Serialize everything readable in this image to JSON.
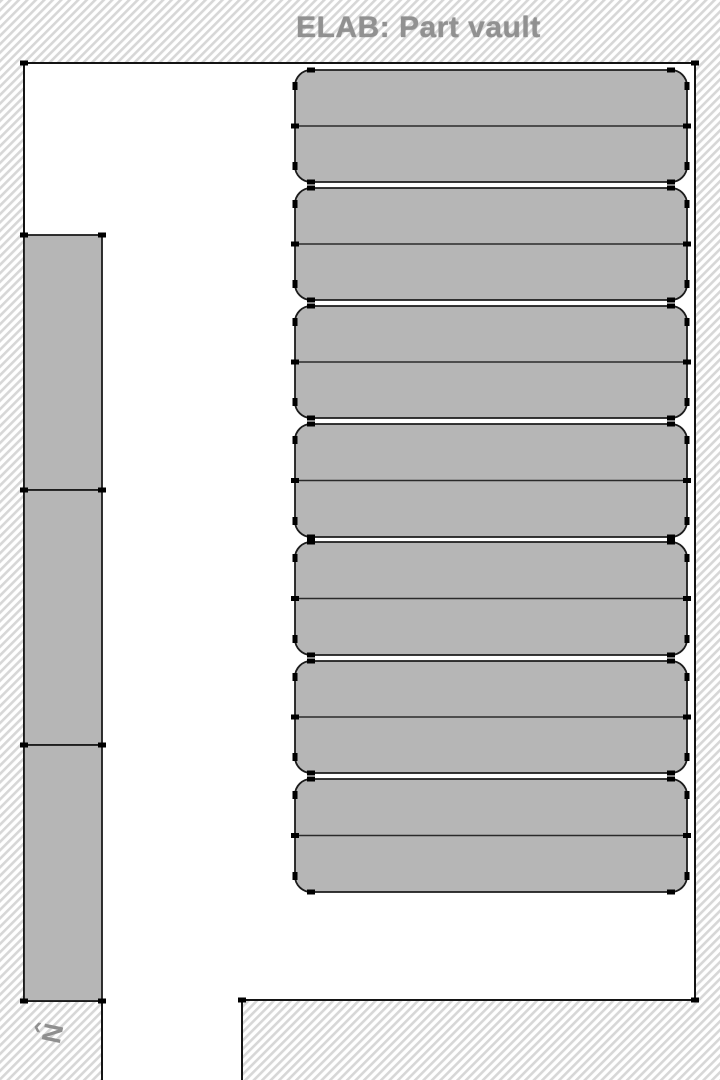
{
  "page": {
    "title": "ELAB: Part vault"
  },
  "compass": {
    "arrow_glyph": "‹",
    "north_label": "N"
  },
  "colors": {
    "exterior_bg": "#ffffff",
    "hatch_stripe": "#d7d7d7",
    "room_fill": "#ffffff",
    "wall_stroke": "#141414",
    "shelf_fill": "#b6b6b6",
    "shelf_stroke": "#1c1c1c",
    "divider_stroke": "#2a2a2a",
    "vertex_fill": "#000000",
    "title_color": "#919191",
    "compass_color": "#8f8f8f"
  },
  "floorplan": {
    "canvas_width": 720,
    "canvas_height": 1080,
    "hatch": {
      "period": 6,
      "stripe_width": 2.6,
      "rotate_deg": -45
    },
    "room_polygon": "24,63 695,63 695,1000 242,1000 242,1080 102,1080 102,1001 24,1001",
    "walls_path": "M24,1001 L24,63 L695,63 L695,1000 L242,1000 L242,1080 M102,1080 L102,1001 L24,1001",
    "room_vertices": [
      [
        24,
        63
      ],
      [
        695,
        63
      ],
      [
        695,
        1000
      ],
      [
        242,
        1000
      ],
      [
        24,
        1001
      ],
      [
        102,
        1001
      ]
    ],
    "left_shelves": [
      {
        "x": 24,
        "y": 235,
        "w": 78,
        "h": 255
      },
      {
        "x": 24,
        "y": 490,
        "w": 78,
        "h": 255
      },
      {
        "x": 24,
        "y": 745,
        "w": 78,
        "h": 256
      }
    ],
    "right_shelves": [
      {
        "x": 295,
        "y": 70,
        "w": 392,
        "h": 112,
        "r": 16
      },
      {
        "x": 295,
        "y": 188,
        "w": 392,
        "h": 112,
        "r": 16
      },
      {
        "x": 295,
        "y": 306,
        "w": 392,
        "h": 112,
        "r": 16
      },
      {
        "x": 295,
        "y": 424,
        "w": 392,
        "h": 113,
        "r": 16
      },
      {
        "x": 295,
        "y": 542,
        "w": 392,
        "h": 113,
        "r": 16
      },
      {
        "x": 295,
        "y": 661,
        "w": 392,
        "h": 112,
        "r": 16
      },
      {
        "x": 295,
        "y": 779,
        "w": 392,
        "h": 113,
        "r": 16
      }
    ]
  }
}
